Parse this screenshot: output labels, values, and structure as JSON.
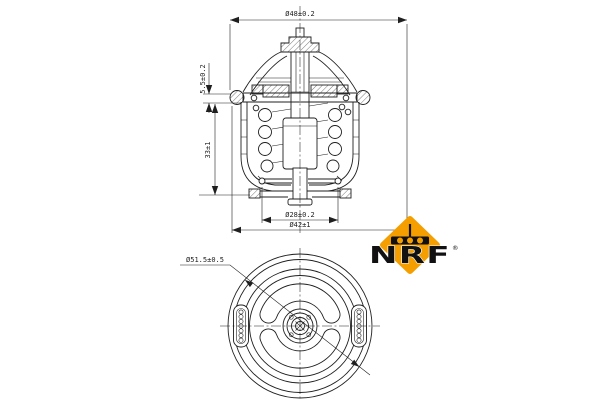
{
  "image_type": "technical part drawing (thermostat)",
  "colors": {
    "background": "#ffffff",
    "line": "#1f1f1f",
    "logo_orange": "#F49E00",
    "logo_black": "#111111"
  },
  "side_view": {
    "dim_outer_diameter": "Ø48±0.2",
    "dim_flange_height": "5.5±0.2",
    "dim_overall_height": "33±1",
    "dim_bypass_diameter": "Ø28±0.2",
    "dim_flange_diameter": "Ø42±1"
  },
  "bottom_view": {
    "dim_outer_diameter": "Ø51.5±0.5"
  },
  "logo": {
    "brand": "NRF",
    "registered_mark": "®"
  }
}
